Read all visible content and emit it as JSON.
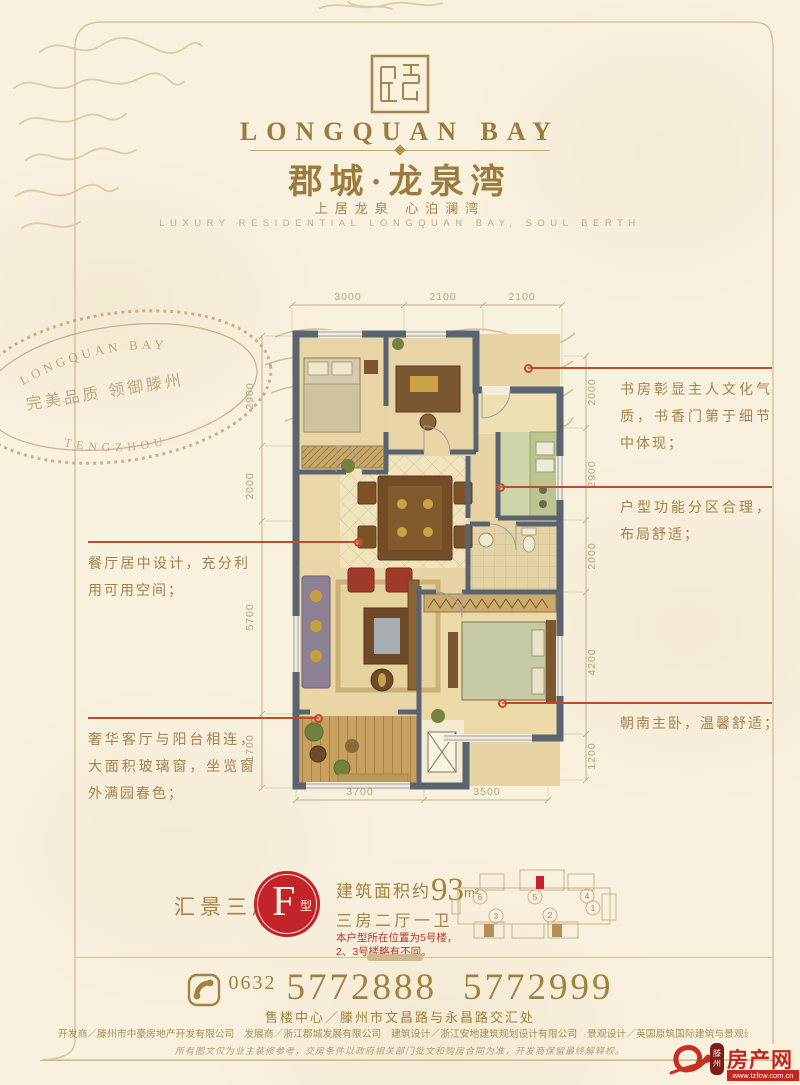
{
  "brand": {
    "name_en": "LONGQUAN BAY",
    "name_cn": "郡城·龙泉湾",
    "slogan_cn": "上居龙泉  心泊澜湾",
    "slogan_en": "LUXURY RESIDENTIAL LONGQUAN BAY, SOUL BERTH"
  },
  "stamp": {
    "arc_top": "LONGQUAN BAY",
    "middle": "完美品质 领御滕州",
    "arc_bottom": "TENGZHOU"
  },
  "plan": {
    "dims": {
      "top": [
        "3000",
        "2100",
        "2100"
      ],
      "left": [
        "2900",
        "2000",
        "5700",
        "1700"
      ],
      "right": [
        "2000",
        "2900",
        "2000",
        "4200",
        "1200"
      ],
      "bottom": [
        "3700",
        "3500"
      ]
    },
    "annotations": {
      "study": "书房彰显主人文化气质，书香门第于细节中体现；",
      "zoning": "户型功能分区合理，布局舒适；",
      "dining": "餐厅居中设计，充分利用可用空间；",
      "living": "奢华客厅与阳台相连，大面积玻璃窗，坐览窗外满园春色；",
      "master": "朝南主卧，温馨舒适；"
    }
  },
  "unit": {
    "series_name": "汇景三房",
    "type_letter": "F",
    "type_suffix": "型",
    "area_prefix": "建筑面积约",
    "area_value": "93",
    "area_unit": "m²",
    "rooms": "三房二厅一卫",
    "note_line1": "本户型所在位置为5号楼，",
    "note_line2": "2、3号楼略有不同。",
    "key_plan_labels": [
      "6",
      "5",
      "4",
      "1",
      "3",
      "2"
    ]
  },
  "contact": {
    "area_code": "0632",
    "phone1": "5772888",
    "phone2": "5772999",
    "address": "售楼中心／滕州市文昌路与永昌路交汇处"
  },
  "footer": {
    "credits": "开发商／滕州市中豪房地产开发有限公司　发展商／浙江郡城发展有限公司　建筑设计／浙江安地建筑规划设计有限公司　景观设计／英国原筑国际建筑与景观设计公司　全案策划／杭州门道",
    "disclaimer": "所有图文仅为业主装修参考，交房条件以政府相关部门批文和购房合同为准，开发商保留最终解释权。",
    "site_logo": {
      "prefix": "滕州",
      "name": "房产网",
      "url": "www.tzfcw.com.cn"
    }
  },
  "colors": {
    "accent_red": "#c3232b",
    "gold": "#9c7b3e",
    "callout": "#bf4a30"
  }
}
